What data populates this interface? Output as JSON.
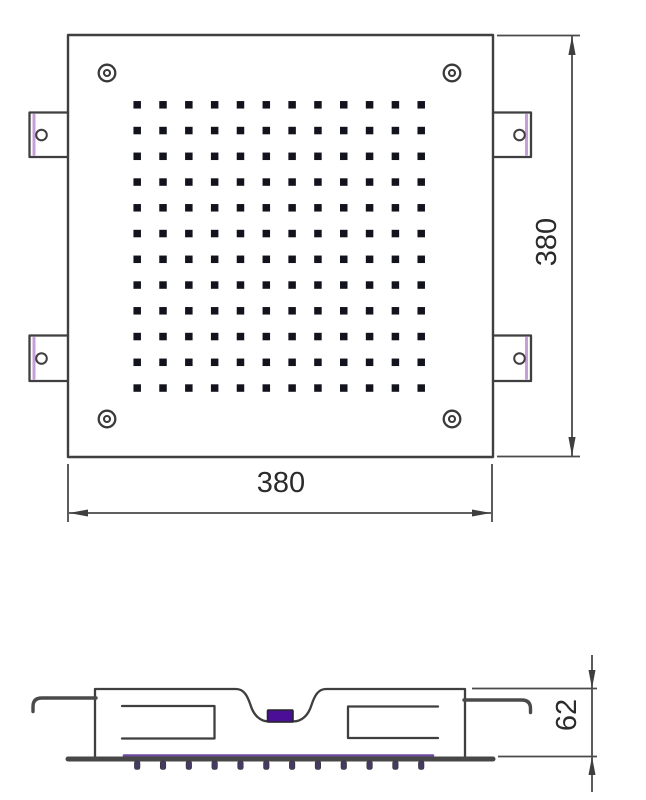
{
  "dimensions": {
    "top_width": "380",
    "top_height": "380",
    "side_height": "62"
  },
  "top_view": {
    "nozzle_grid": {
      "rows": 12,
      "cols": 12,
      "x0": 137.2,
      "y0": 104.8,
      "dx": 25.82,
      "dy": 25.75,
      "size": 7.5
    }
  },
  "side_view": {
    "teeth": {
      "count": 12,
      "x0": 137.2,
      "dx": 25.82,
      "y": 761,
      "width": 5.5,
      "height": 8.5
    }
  },
  "colors": {
    "line": "#3f3f3f",
    "dim": "#4a4a4a",
    "text": "#2b2b2b",
    "nozzle": "#13131d",
    "bracket_accent": "#c79fd8",
    "inlet": "#4b0e97",
    "flange": "#474747",
    "flange_accent": "#6c4a9e",
    "tooth": "#453a61"
  }
}
